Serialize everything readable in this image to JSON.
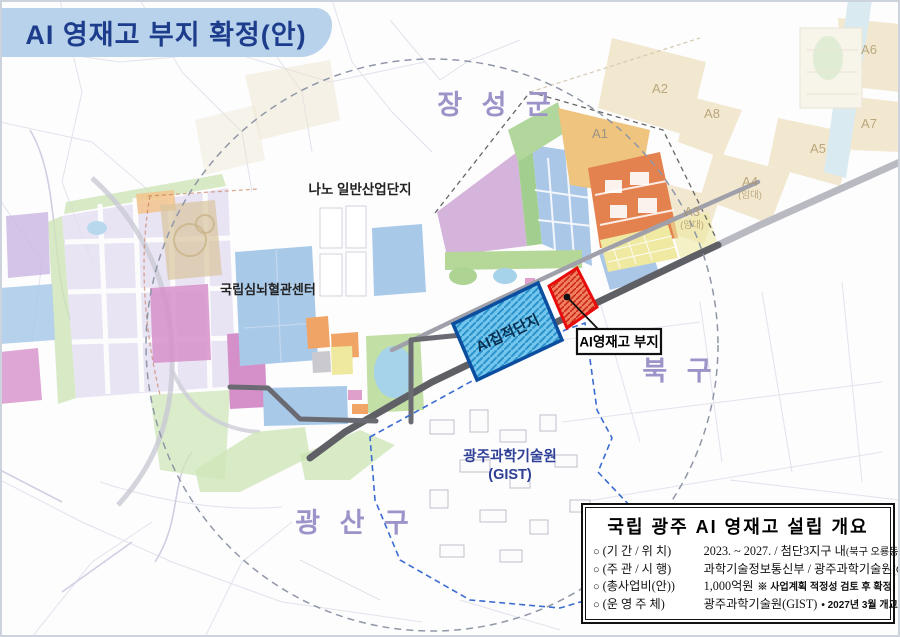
{
  "banner": {
    "title": "AI 영재고 부지 확정(안)"
  },
  "map": {
    "regions": [
      {
        "id": "jangseong",
        "label": "장 성 군"
      },
      {
        "id": "bukgu",
        "label": "북  구"
      },
      {
        "id": "gwangsan",
        "label": "광 산 구"
      }
    ],
    "places": [
      {
        "id": "nano",
        "label": "나노 일반산업단지"
      },
      {
        "id": "heart-center",
        "label": "국립심뇌혈관센터"
      },
      {
        "id": "gist",
        "label": "광주과학기술원",
        "label2": "(GIST)"
      }
    ],
    "sites": [
      {
        "id": "ai-cluster",
        "label": "AI집적단지",
        "fill": "#74c6ec",
        "border": "#0b4ea0"
      },
      {
        "id": "ai-school",
        "label": "AI영재고 부지",
        "fill": "#f28060",
        "border": "#e80c0c"
      }
    ],
    "callout": {
      "label": "AI영재고 부지"
    },
    "zones": [
      {
        "label": "A1"
      },
      {
        "label": "A2"
      },
      {
        "label": "A3",
        "sub": "(임대)"
      },
      {
        "label": "A4",
        "sub": "(임대)"
      },
      {
        "label": "A5"
      },
      {
        "label": "A6"
      },
      {
        "label": "A7"
      },
      {
        "label": "A8"
      }
    ]
  },
  "infobox": {
    "title": "국립 광주 AI 영재고 설립 개요",
    "rows": [
      {
        "bullet": "○",
        "key": "(기 간 / 위 치)",
        "value": "2023. ~ 2027. / 첨단3지구 내",
        "small": "(북구 오룡동)",
        "note": ""
      },
      {
        "bullet": "○",
        "key": "(주 관 / 시 행)",
        "value": "과학기술정보통신부 / 광주과학기술원",
        "small": "(GIST)",
        "note": ""
      },
      {
        "bullet": "○",
        "key": "(총사업비(안))",
        "value": "1,000억원",
        "small": "",
        "note": "※ 사업계획 적정성 검토 후 확정"
      },
      {
        "bullet": "○",
        "key": "(운 영 주 체)",
        "value": "광주과학기술원(GIST)",
        "small": "",
        "note": "• 2027년 3월 개교 목표"
      }
    ]
  },
  "colors": {
    "banner_bg": "#b7d2ea",
    "banner_text": "#1d3d8c",
    "ai_cluster_fill": "#74c6ec",
    "ai_cluster_border": "#0b4ea0",
    "ai_school_fill": "#f28060",
    "ai_school_border": "#e80c0c",
    "region_label": "#9c94c8",
    "gist_label": "#2e3f96",
    "boundary_circle": "#8f97a6"
  }
}
